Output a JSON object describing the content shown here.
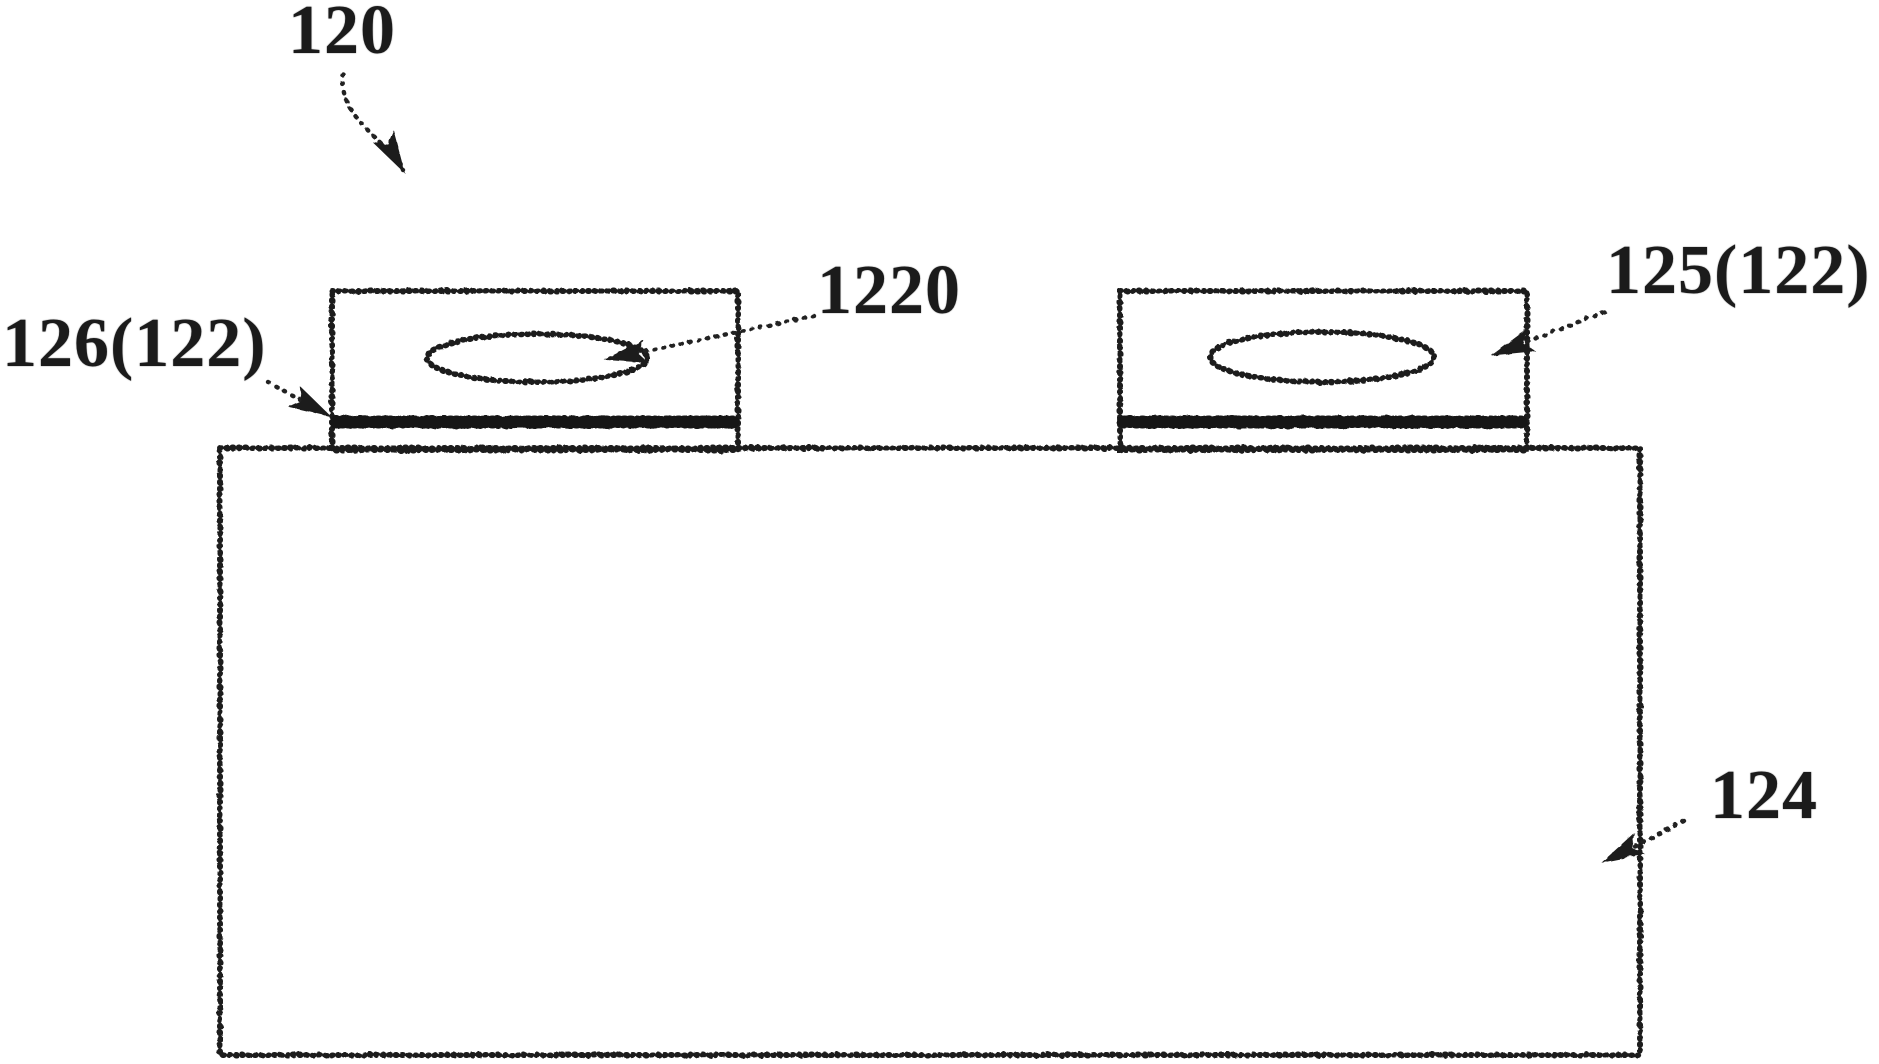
{
  "figure": {
    "background_color": "#ffffff",
    "line_color": "#1c1c1c",
    "labels": {
      "assembly": "120",
      "left_terminal": "126(122)",
      "terminal_hole": "1220",
      "right_terminal": "125(122)",
      "case_body": "124"
    }
  }
}
